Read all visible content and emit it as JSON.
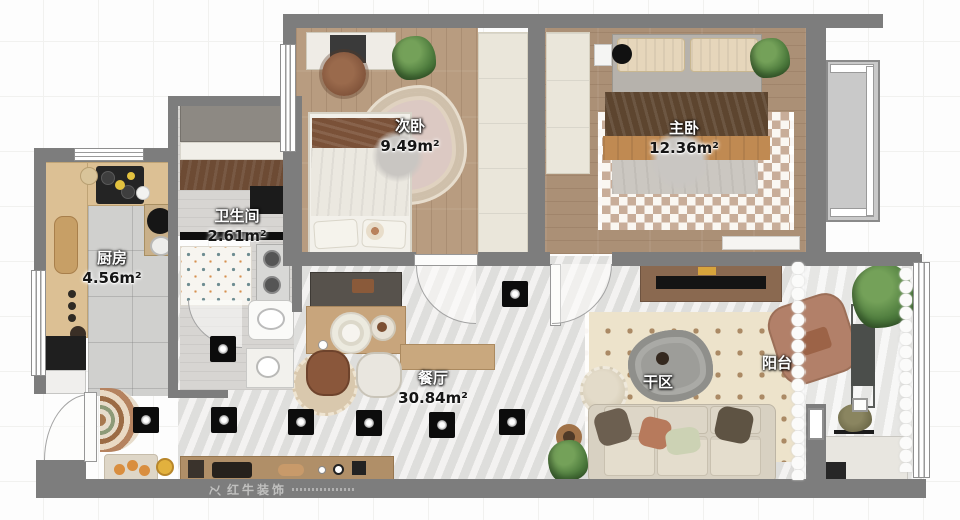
{
  "plan": {
    "rooms": [
      {
        "key": "secondary-bedroom",
        "name": "次卧",
        "area": "9.49m²"
      },
      {
        "key": "master-bedroom",
        "name": "主卧",
        "area": "12.36m²"
      },
      {
        "key": "bathroom",
        "name": "卫生间",
        "area": "2.61m²"
      },
      {
        "key": "kitchen",
        "name": "厨房",
        "area": "4.56m²"
      },
      {
        "key": "dining-living",
        "name": "餐厅",
        "area": "30.84m²"
      },
      {
        "key": "dry-area",
        "name": "干区",
        "area": ""
      },
      {
        "key": "balcony",
        "name": "阳台",
        "area": ""
      }
    ],
    "watermark": {
      "brand": "红牛装饰"
    },
    "icons": {
      "ceiling_light": "black-square-spotlight-marker",
      "lamp": "gray-circle-ceiling-lamp",
      "door": "quarter-arc-swing",
      "window": "double-line-strip"
    },
    "colors": {
      "wall": "#7d7d7d",
      "wood": "#b89c80",
      "wood2": "#ab9076",
      "marble": "#e4e3e1",
      "tile": "#d0d0ce",
      "cream": "#eae6da",
      "rug_check": "#c8ad99",
      "rug_dot": "#ab8a65",
      "bath_dot": "#6e8d92",
      "plant": "#4c7a3c"
    }
  }
}
